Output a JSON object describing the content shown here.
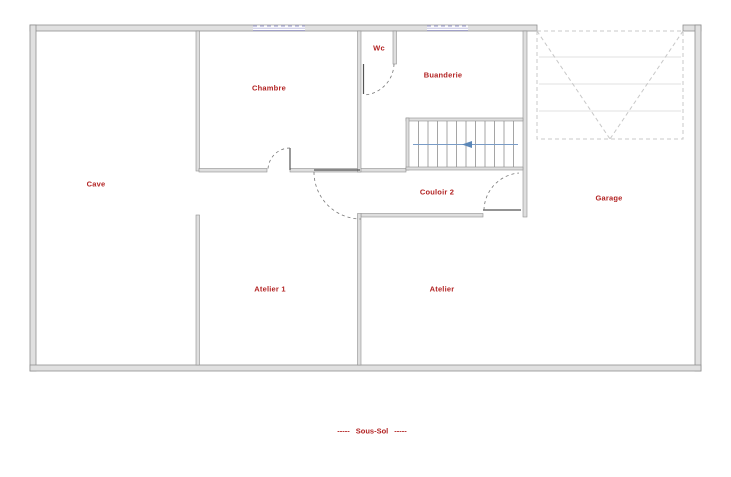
{
  "plan": {
    "rooms": {
      "cave": "Cave",
      "chambre": "Chambre",
      "wc": "Wc",
      "buanderie": "Buanderie",
      "couloir": "Couloir 2",
      "garage": "Garage",
      "atelier1": "Atelier 1",
      "atelier": "Atelier"
    },
    "footer": {
      "left_dashes": "-----",
      "title": "Sous-Sol",
      "right_dashes": "-----"
    },
    "colors": {
      "label": "#b22222",
      "wall_stroke": "#8f8f8f",
      "wall_fill": "#e0e0e0",
      "window": "#9a9ace",
      "stair_arrow": "#5b87b8",
      "garage_door": "#c8c8c8"
    }
  }
}
